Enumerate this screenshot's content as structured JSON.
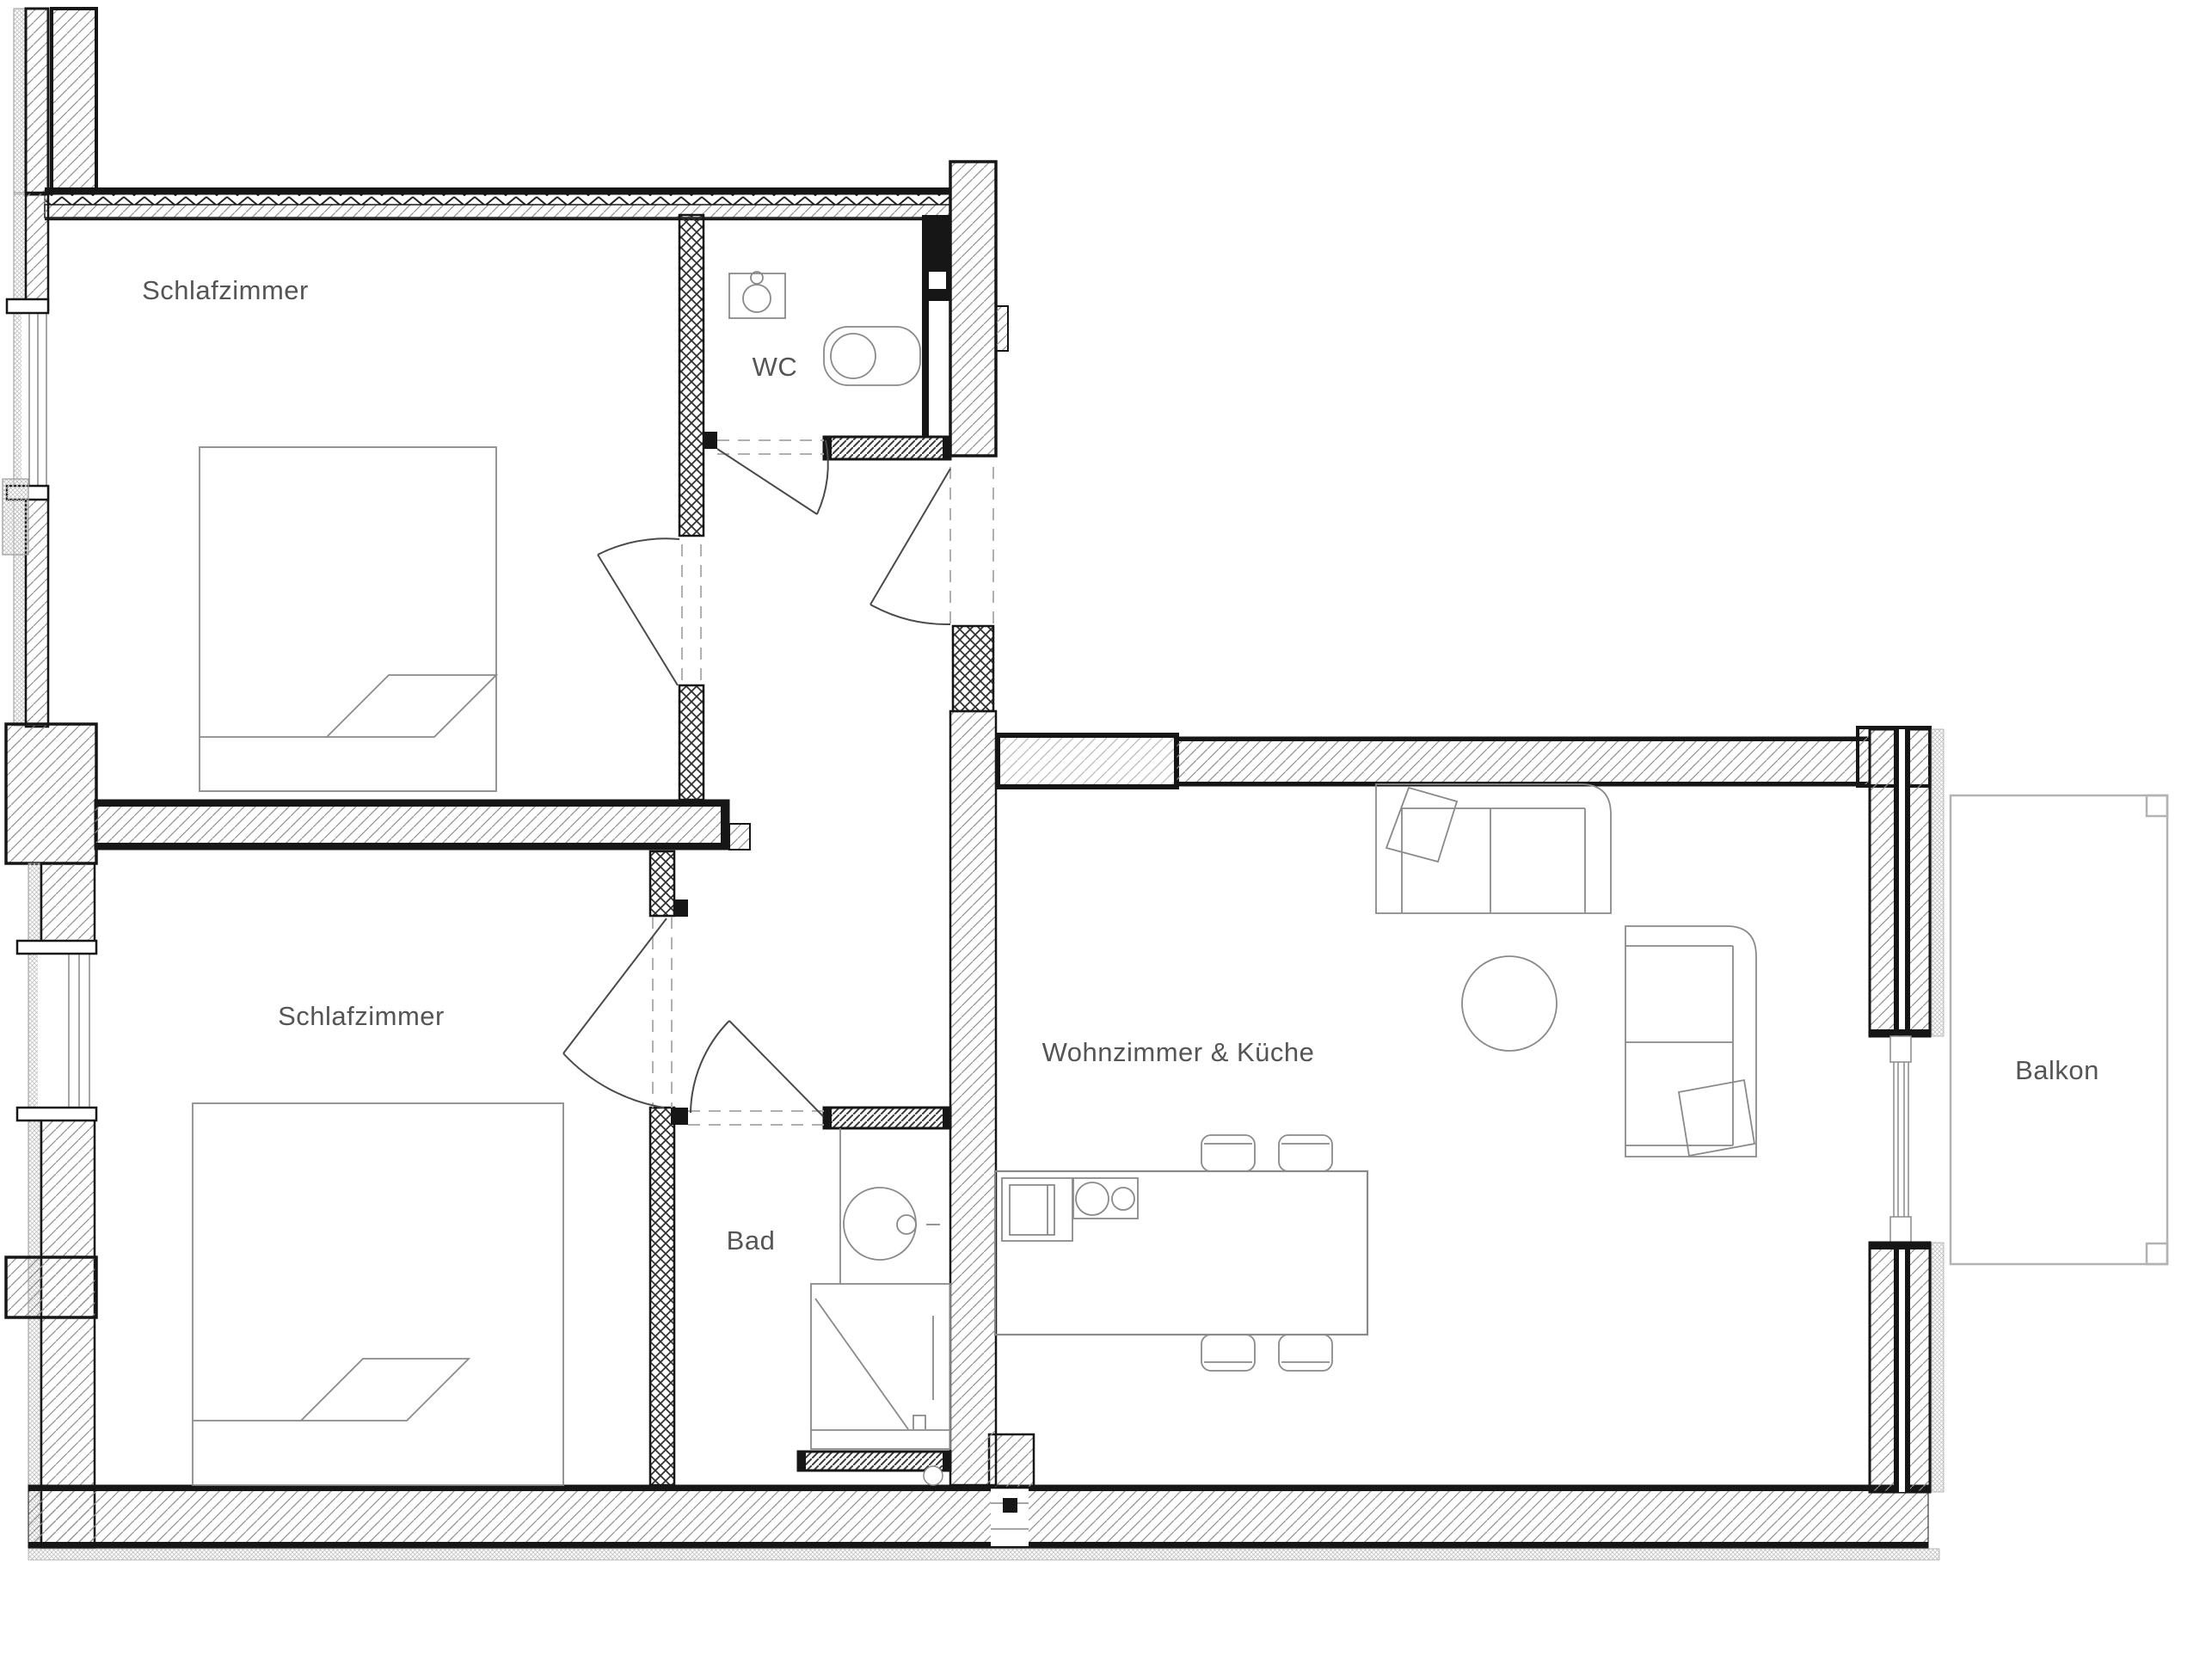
{
  "plan_title": "Apartment floor plan",
  "rooms": {
    "bedroom_top": {
      "label": "Schlafzimmer"
    },
    "bedroom_bottom": {
      "label": "Schlafzimmer"
    },
    "wc": {
      "label": "WC"
    },
    "bath": {
      "label": "Bad"
    },
    "living_kitchen": {
      "label": "Wohnzimmer & Küche"
    },
    "balcony": {
      "label": "Balkon"
    }
  },
  "colors": {
    "wall_line": "#161616",
    "exterior_hatch": "#8f8f8f",
    "interior_cross_hatch": "#2e2e2e",
    "furniture_line": "#8a8a8a",
    "label_text": "#555555",
    "balcony_line": "#b3b3b3",
    "opening_dash": "#b0b0b0"
  }
}
